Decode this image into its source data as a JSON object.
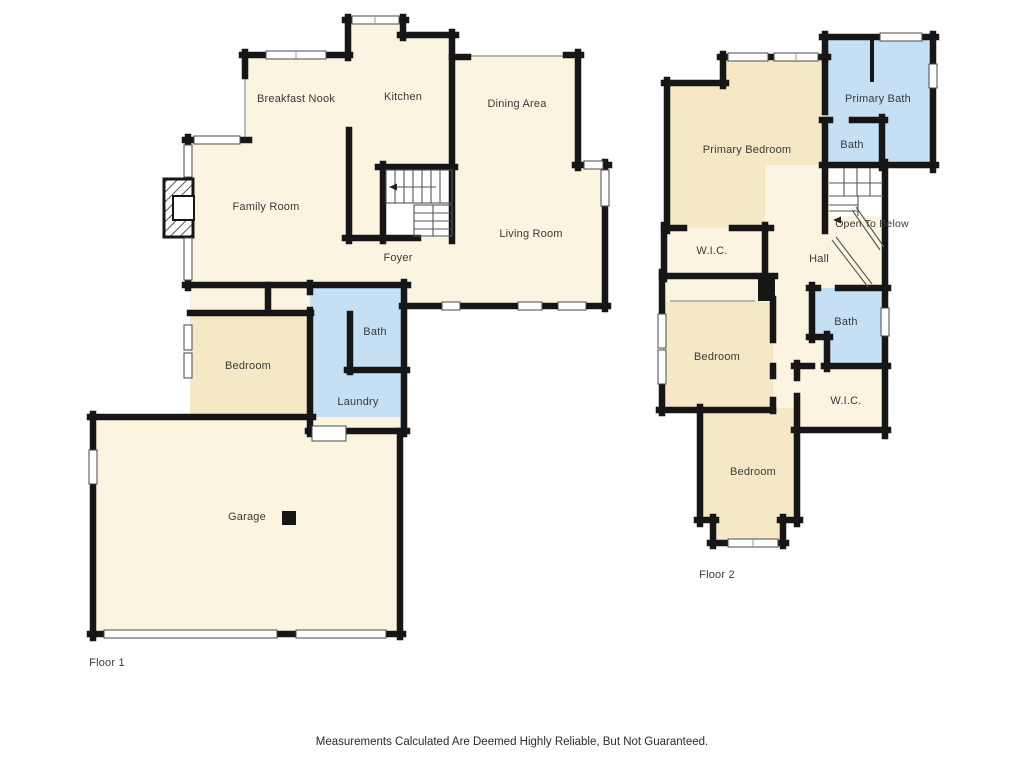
{
  "colors": {
    "room_fill": "#FAF4E0",
    "bedroom_fill": "#F7E8C5",
    "bath_fill": "#C5E0F5",
    "wall": "#161616",
    "label_text": "#3A3A3A",
    "background": "#FFFFFF"
  },
  "floor1": {
    "label": "Floor 1",
    "rooms": {
      "breakfast_nook": "Breakfast Nook",
      "kitchen": "Kitchen",
      "dining": "Dining Area",
      "family": "Family Room",
      "living": "Living Room",
      "foyer": "Foyer",
      "bath": "Bath",
      "bedroom": "Bedroom",
      "laundry": "Laundry",
      "garage": "Garage"
    }
  },
  "floor2": {
    "label": "Floor 2",
    "rooms": {
      "primary_bedroom": "Primary Bedroom",
      "primary_bath": "Primary Bath",
      "bath_upper": "Bath",
      "open_to_below": "Open To Below",
      "wic_upper": "W.I.C.",
      "hall": "Hall",
      "bath_mid": "Bath",
      "bedroom_mid": "Bedroom",
      "wic_lower": "W.I.C.",
      "bedroom_lower": "Bedroom"
    }
  },
  "footer": {
    "disclaimer": "Measurements Calculated Are Deemed Highly Reliable, But Not Guaranteed."
  }
}
